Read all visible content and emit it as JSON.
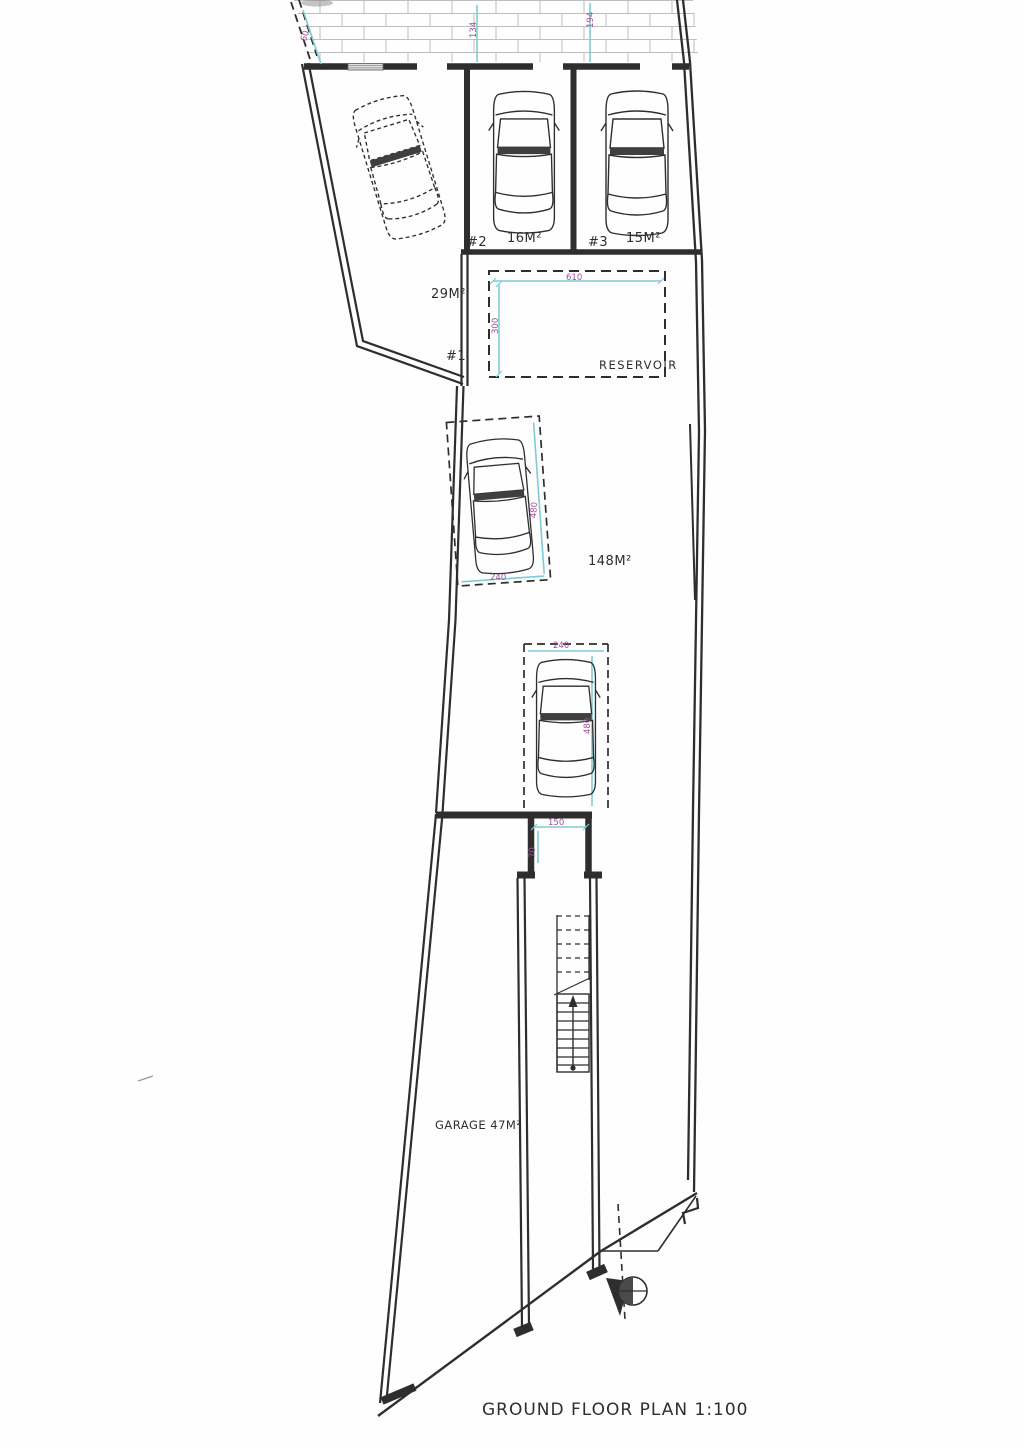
{
  "sheet": {
    "title": "GROUND FLOOR PLAN 1:100"
  },
  "labels": {
    "bay1_number": "#1",
    "bay1_area": "29M²",
    "bay2_number": "#2",
    "bay2_area": "16M²",
    "bay3_number": "#3",
    "bay3_area": "15M²",
    "hall_area": "148M²",
    "garage": "GARAGE 47M²",
    "reservoir": "RESERVOIR"
  },
  "dimensions": {
    "street_left": "60",
    "street_mid": "134",
    "street_right": "194",
    "reservoir_width": "610",
    "reservoir_depth": "300",
    "upper_space_width": "240",
    "upper_space_length": "480",
    "lower_space_width": "240",
    "lower_space_length": "480",
    "lobby_width": "150",
    "lobby_depth": "70"
  },
  "colors": {
    "ink": "#2e2e2e",
    "dimension_line": "#7fccd4",
    "dimension_text": "#9e4f96",
    "hatch_line": "#bdbdc4",
    "paper": "#fefefe"
  }
}
